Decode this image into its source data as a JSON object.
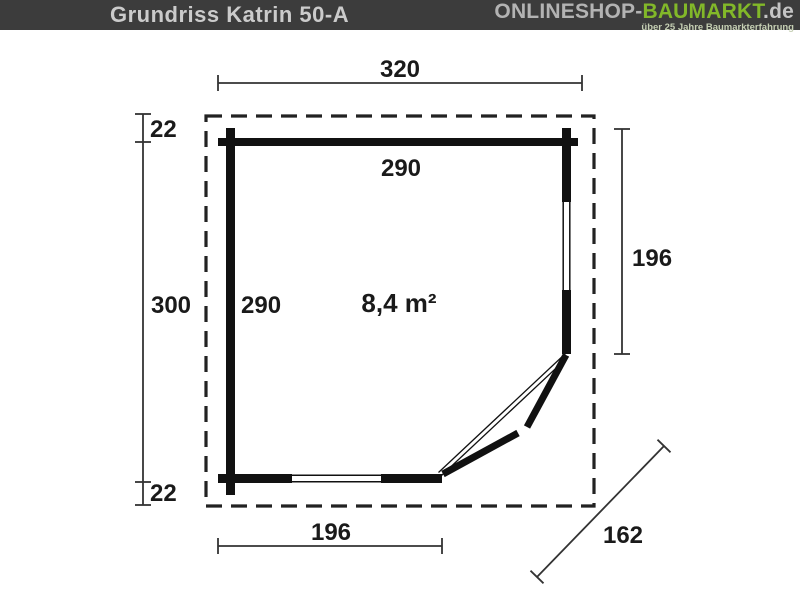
{
  "header": {
    "title": "Grundriss Katrin 50-A",
    "logo": {
      "part_gray": "ONLINESHOP-",
      "part_green": "BAUMARKT",
      "part_de": ".de",
      "tagline": "über 25 Jahre Baumarkterfahrung"
    },
    "colors": {
      "bar_bg": "#3c3c3c",
      "title": "#cbcbcb",
      "logo_gray": "#b3b3b3",
      "logo_green": "#82b829",
      "tagline": "#c5cfb3"
    }
  },
  "floorplan": {
    "name": "Katrin 50-A",
    "area_label": "8,4 m²",
    "dimensions": {
      "outer_width_top": "320",
      "inner_width_top": "290",
      "roof_overhang_top": "22",
      "outer_height_left": "300",
      "inner_height_left": "290",
      "right_wall_length": "196",
      "roof_overhang_bottom": "22",
      "bottom_wall_length": "196",
      "diagonal_wall_length": "162"
    },
    "colors": {
      "wall": "#111111",
      "dimension_line": "#333333",
      "roof_dashed": "#222222"
    }
  }
}
